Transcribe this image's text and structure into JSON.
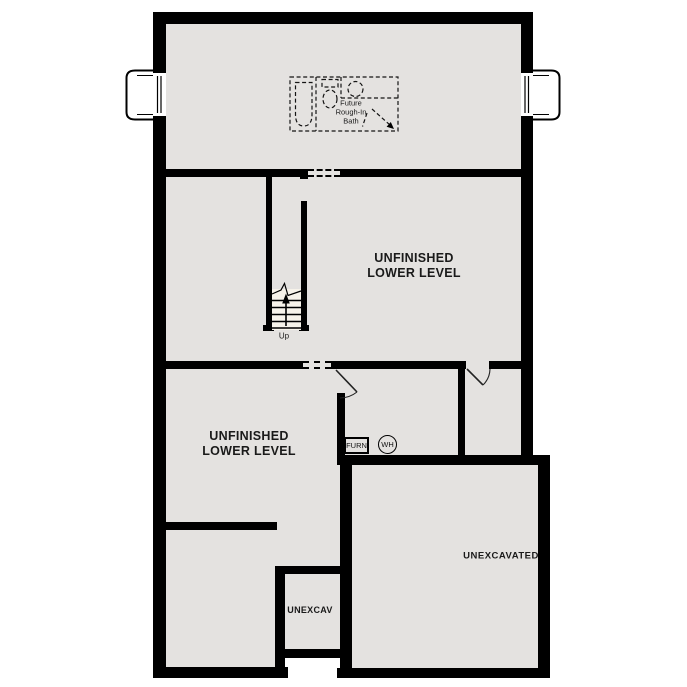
{
  "plan": {
    "type": "architectural-floor-plan",
    "level": "lower-level-basement",
    "rooms": {
      "middle": {
        "line1": "UNFINISHED",
        "line2": "LOWER LEVEL"
      },
      "left": {
        "line1": "UNFINISHED",
        "line2": "LOWER LEVEL"
      },
      "unexcavated": {
        "label": "UNEXCAVATED"
      },
      "unexcav": {
        "label": "UNEXCAV"
      }
    },
    "stairs": {
      "direction_label": "Up"
    },
    "equipment": {
      "furnace_label": "FURN",
      "water_heater_label": "WH"
    },
    "future_bath": {
      "line1": "Future",
      "line2": "Rough-In",
      "line3": "Bath",
      "symbols": [
        "bathtub-icon",
        "toilet-icon",
        "sink-icon",
        "drain-arrow-icon"
      ]
    },
    "symbols": [
      "egress-window-symbol-left",
      "egress-window-symbol-right",
      "door-swing-symbol",
      "dashed-wall-opening"
    ],
    "colors": {
      "wall": "#000000",
      "floor": "#e4e2e0",
      "stair_fill": "#f7f3ea",
      "background": "#ffffff",
      "text": "#1a1a1a"
    }
  }
}
